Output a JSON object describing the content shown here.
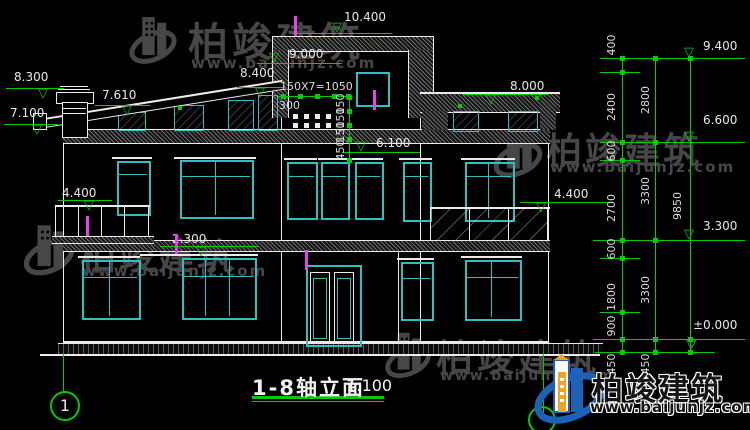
{
  "title": {
    "text": "1-8轴立面",
    "scale": "1:100"
  },
  "axis": {
    "label": "1"
  },
  "symbols": {
    "level_triangle": "▽"
  },
  "watermark": {
    "brand": "柏竣建筑",
    "url": "www.baijunjz.com"
  },
  "logo": {
    "brand": "柏竣建筑",
    "url": "www.baijunjz.com"
  },
  "levels": {
    "left_8300": "8.300",
    "left_7610": "7.610",
    "left_7100": "7.100",
    "left_8400": "8.400",
    "top_10400": "10.400",
    "top_9000": "9.000",
    "top_8000": "8.000",
    "mid_6100": "6.100",
    "left_4400": "4.400",
    "left_2300": "2.300",
    "right_4400": "4.400",
    "chain_9400": "9.400",
    "chain_6600": "6.600",
    "chain_3300": "3.300",
    "chain_0000": "±0.000"
  },
  "dims": {
    "top_run": "150X7=1050",
    "top_300": "300",
    "stack": [
      "150",
      "150",
      "150",
      "450"
    ],
    "inner": [
      "400",
      "2400",
      "600",
      "2700",
      "600",
      "1800",
      "900",
      "450"
    ],
    "middle": [
      "2800",
      "3300",
      "3300",
      "450"
    ],
    "overall": "9850"
  },
  "colors": {
    "background": "#000000",
    "line": "#ebebeb",
    "window": "#30bfbf",
    "dimension": "#00cc00",
    "tick": "#ef3cef",
    "watermark": "#474747",
    "brand_blue": "#1c63b7",
    "brand_orange": "#f6a21d"
  }
}
